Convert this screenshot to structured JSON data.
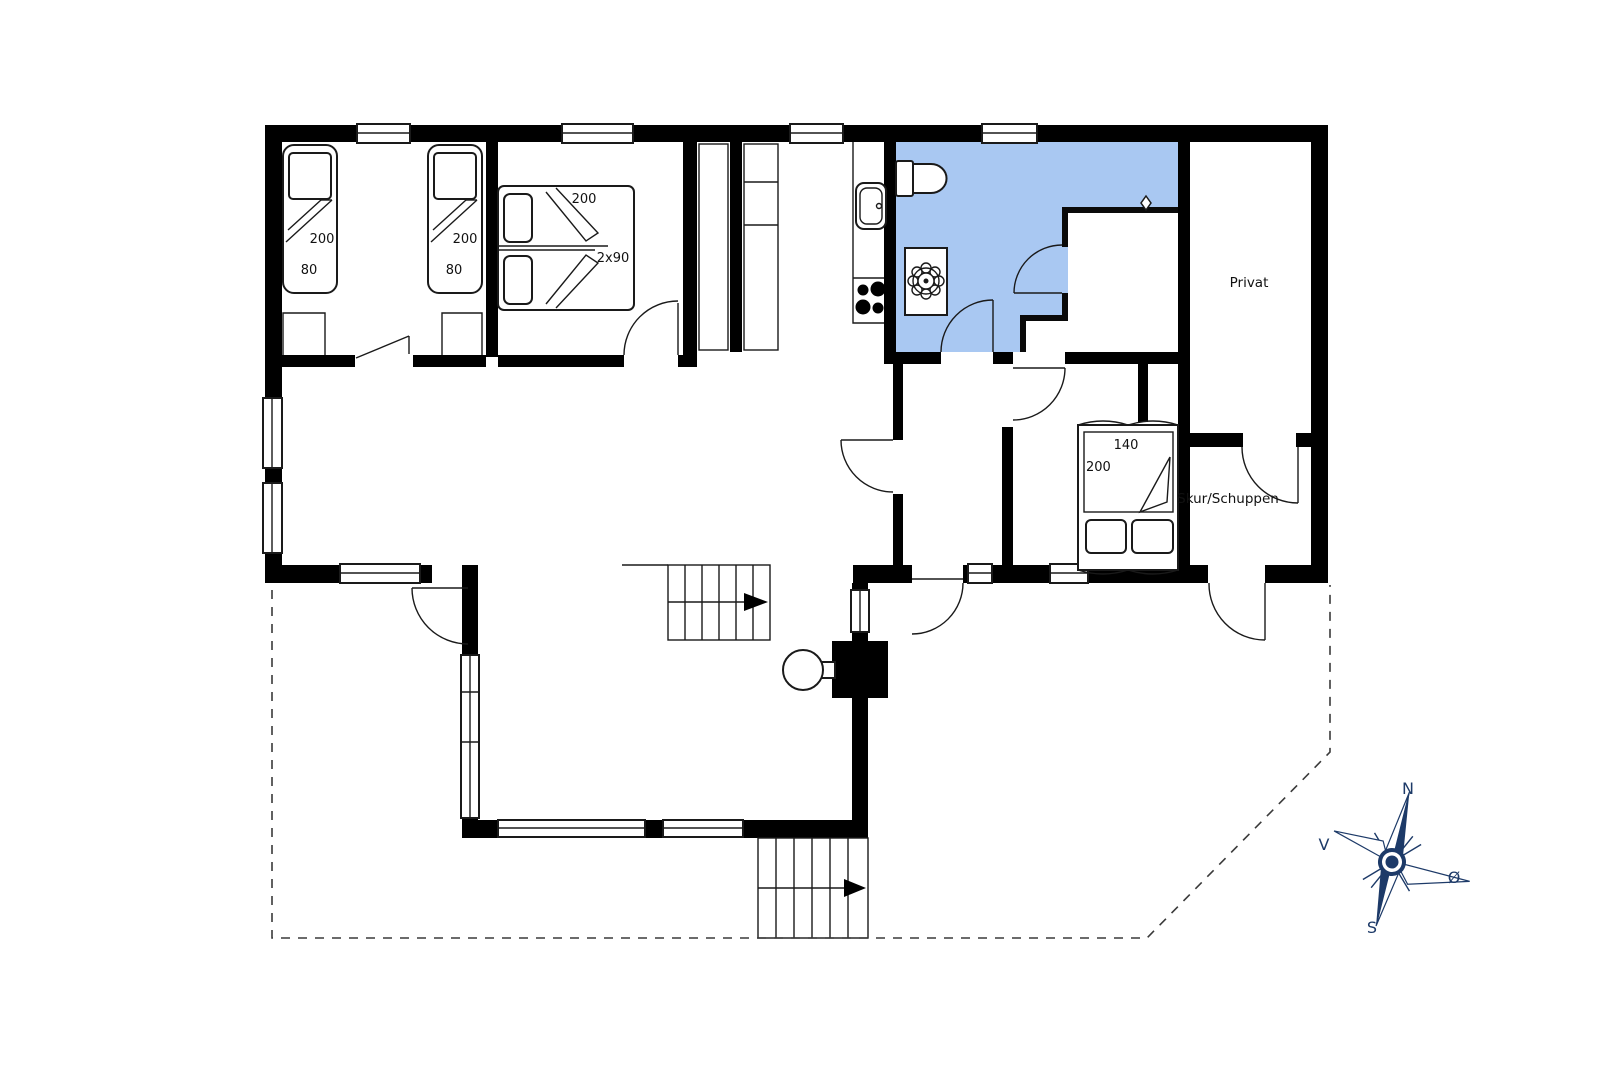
{
  "colors": {
    "wall": "#000000",
    "bathroom_fill": "#a9c8f2",
    "compass": "#1d3a68",
    "line": "#1a1a1a"
  },
  "rooms": {
    "privat": "Privat",
    "skur": "Skur/Schuppen"
  },
  "beds": {
    "single_length": "200",
    "single_width": "80",
    "double_length": "200",
    "double_width": "2x90",
    "master_width": "140",
    "master_length": "200"
  },
  "compass": {
    "north": "N",
    "east": "Ø",
    "south": "S",
    "west": "V"
  }
}
